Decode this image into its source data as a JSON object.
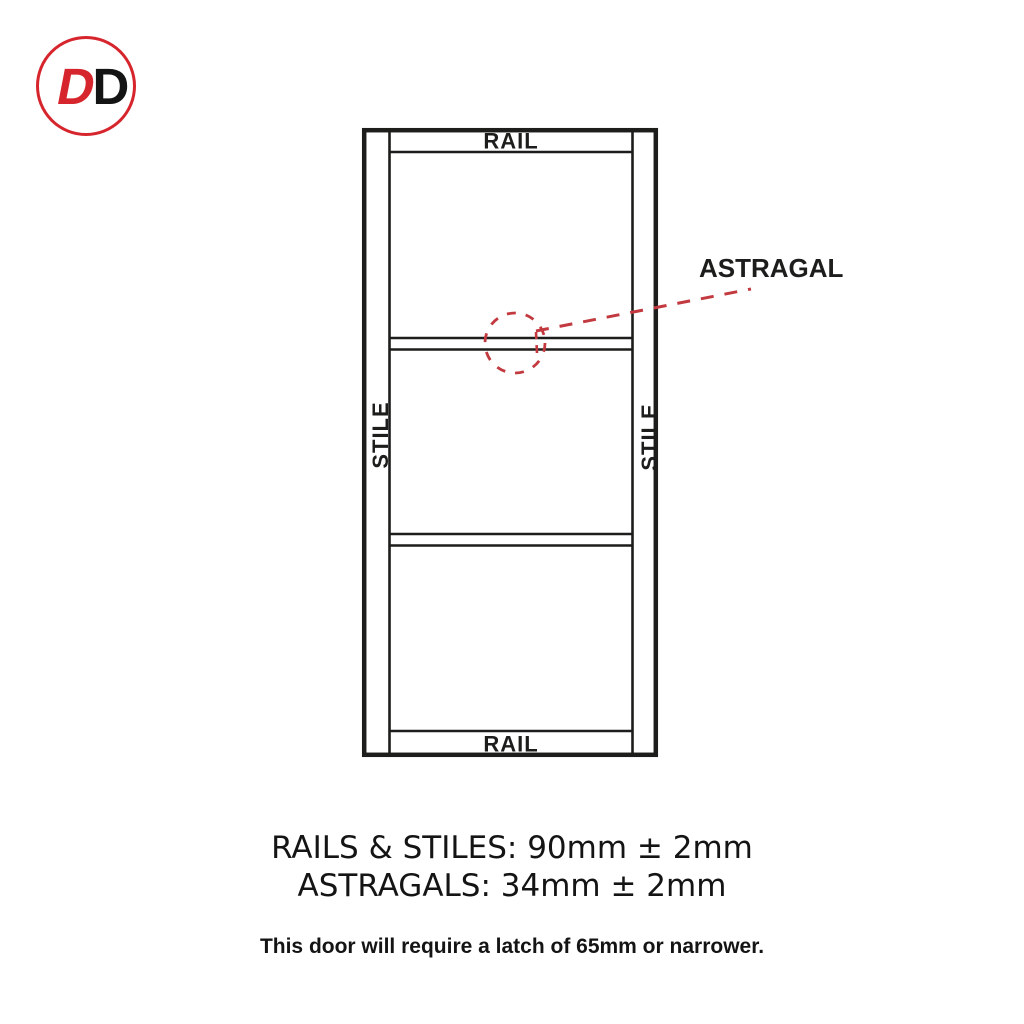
{
  "logo": {
    "letter_red": "D",
    "letter_black": "D"
  },
  "diagram": {
    "top_rail_label": "RAIL",
    "bottom_rail_label": "RAIL",
    "left_stile_label": "STILE",
    "right_stile_label": "STILE",
    "astragal_label": "ASTRAGAL"
  },
  "specs": {
    "rails_stiles": "RAILS & STILES: 90mm ± 2mm",
    "astragals": "ASTRAGALS: 34mm ± 2mm",
    "latch_note": "This door will require a latch of 65mm or narrower."
  },
  "colors": {
    "door_line": "#1d1d1b",
    "logo_red": "#d6252c",
    "callout_red": "#c23a3f",
    "background": "#ffffff"
  }
}
